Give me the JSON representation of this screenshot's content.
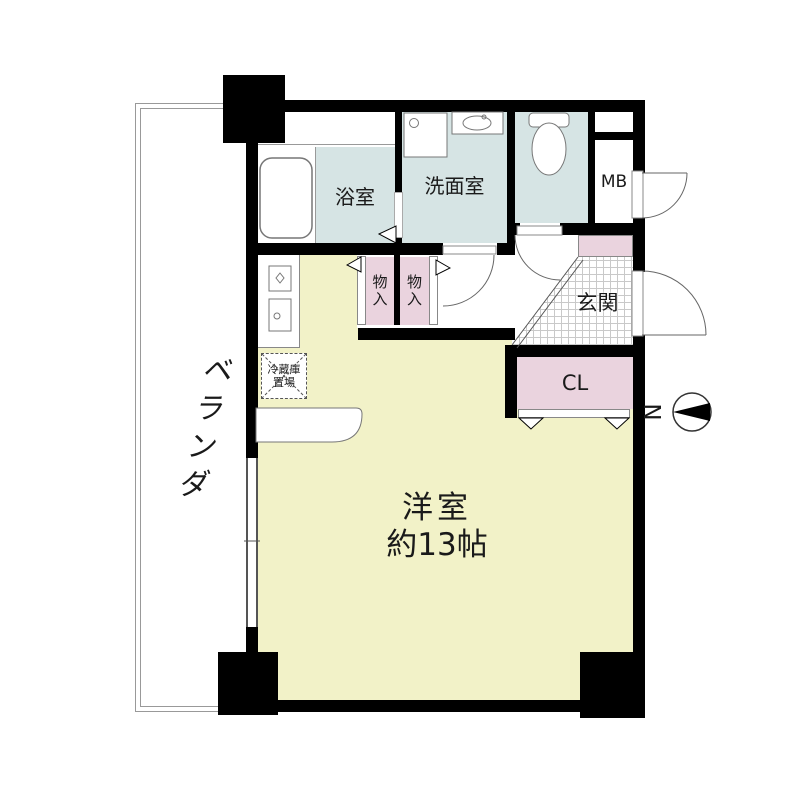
{
  "floorplan": {
    "balcony": {
      "label": "ベランダ"
    },
    "bath": {
      "label": "浴室"
    },
    "washroom": {
      "label": "洗面室"
    },
    "meter_box": {
      "label": "MB"
    },
    "storage_left": {
      "label": "物入"
    },
    "storage_right": {
      "label": "物入"
    },
    "entrance": {
      "label": "玄関"
    },
    "closet": {
      "label": "CL"
    },
    "fridge_space": {
      "line1": "冷蔵庫",
      "line2": "置場"
    },
    "main_room": {
      "line1": "洋室",
      "line2": "約13帖"
    },
    "compass": {
      "label": "N"
    },
    "colors": {
      "wall": "#000000",
      "room_blue": "#d6e4e4",
      "room_pink": "#ead3de",
      "room_yellow": "#f2f2c8",
      "tile_line": "#c9c9c9",
      "line_gray": "#888888"
    }
  }
}
